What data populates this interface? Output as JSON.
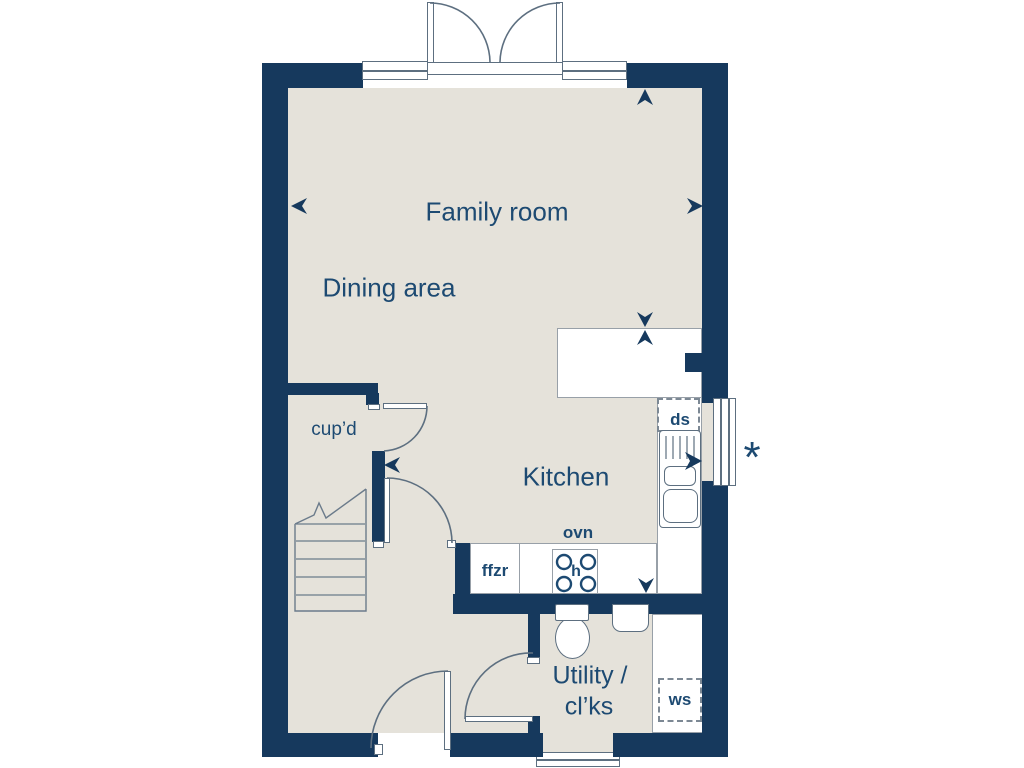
{
  "plan": {
    "title": "Ground floor plan",
    "rooms": {
      "family": {
        "label": "Family room"
      },
      "dining": {
        "label": "Dining area"
      },
      "kitchen": {
        "label": "Kitchen"
      },
      "cupboard": {
        "label": "cup’d"
      },
      "utility": {
        "line1": "Utility /",
        "line2": "cl’ks"
      }
    },
    "fixtures": {
      "dishwasher_space": {
        "label": "ds"
      },
      "oven": {
        "label": "ovn"
      },
      "fridge_freezer": {
        "label": "ffzr"
      },
      "washer_space": {
        "label": "ws"
      },
      "hob": {
        "label": "h"
      }
    },
    "markers": {
      "asterisk": "*"
    },
    "colors": {
      "wall": "#16395D",
      "floor": "#E5E2DA",
      "text": "#1D4A72",
      "line": "#5D6F80",
      "counter_border": "#98A0A8",
      "background": "#FFFFFF"
    }
  }
}
